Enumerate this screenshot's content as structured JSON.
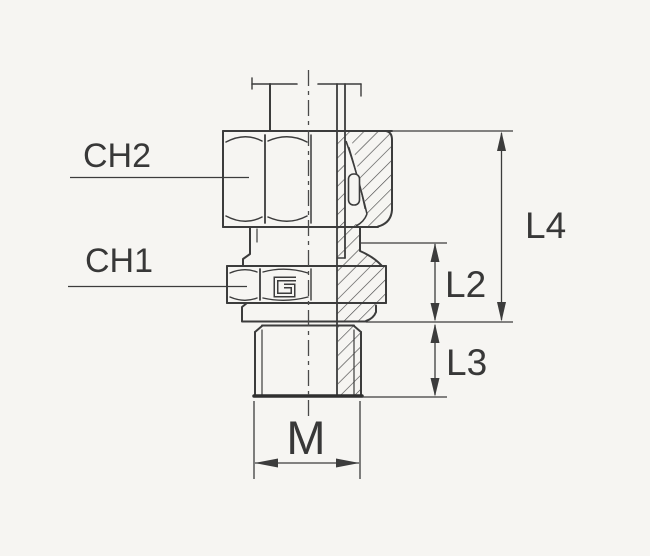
{
  "diagram": {
    "type": "technical-drawing",
    "subject": "Male stud compression fitting, half-section engineering drawing",
    "labels": {
      "ch2": "CH2",
      "ch1": "CH1",
      "l4": "L4",
      "l2": "L2",
      "l3": "L3",
      "m": "M"
    },
    "colors": {
      "background": "#f6f5f2",
      "line": "#3c3c3c",
      "thin_line": "#4a4a4a",
      "text": "#383838"
    }
  }
}
